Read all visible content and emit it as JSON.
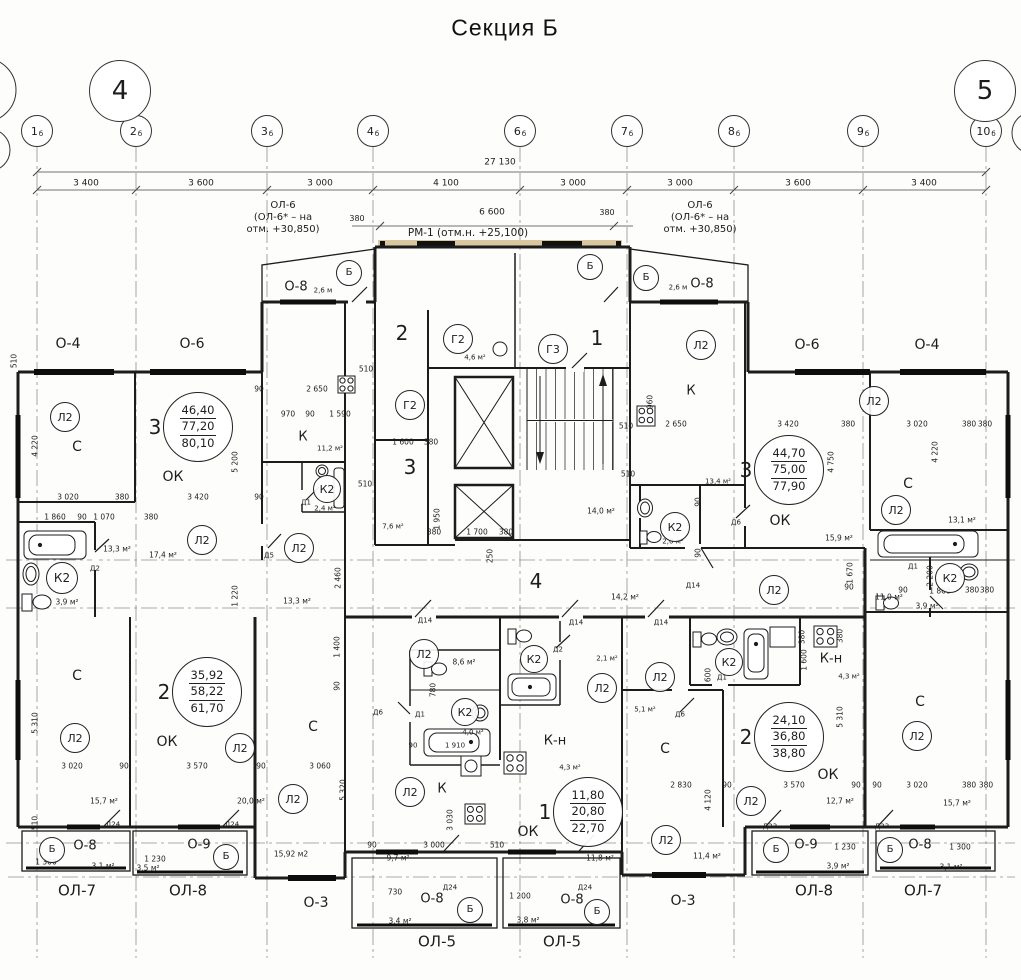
{
  "title": "Секция Б",
  "colors": {
    "wall": "#1c1c1c",
    "grid": "#8f8f8f",
    "dim": "#444444",
    "lintel_tan": "#d9c7a0"
  },
  "section_markers": [
    {
      "label": "4",
      "x": 120,
      "y": 91
    },
    {
      "label": "5",
      "x": 985,
      "y": 91
    }
  ],
  "axes": [
    {
      "label": "1",
      "sub": "б",
      "x": 37
    },
    {
      "label": "2",
      "sub": "б",
      "x": 136
    },
    {
      "label": "3",
      "sub": "б",
      "x": 267
    },
    {
      "label": "4",
      "sub": "б",
      "x": 373
    },
    {
      "label": "6",
      "sub": "б",
      "x": 520
    },
    {
      "label": "7",
      "sub": "б",
      "x": 627
    },
    {
      "label": "8",
      "sub": "б",
      "x": 734
    },
    {
      "label": "9",
      "sub": "б",
      "x": 863
    },
    {
      "label": "10",
      "sub": "б",
      "x": 986
    }
  ],
  "dims": {
    "total": "27 130",
    "total_x": 500,
    "total_y": 163,
    "segments": [
      {
        "label": "3 400",
        "x": 86
      },
      {
        "label": "3 600",
        "x": 201
      },
      {
        "label": "3 000",
        "x": 320
      },
      {
        "label": "4 100",
        "x": 446
      },
      {
        "label": "3 000",
        "x": 573
      },
      {
        "label": "3 000",
        "x": 680
      },
      {
        "label": "3 600",
        "x": 798
      },
      {
        "label": "3 400",
        "x": 924
      }
    ]
  },
  "stamps": [
    {
      "num": "3",
      "values": [
        "46,40",
        "77,20",
        "80,10"
      ],
      "x": 198,
      "y": 427
    },
    {
      "num": "3",
      "values": [
        "44,70",
        "75,00",
        "77,90"
      ],
      "x": 789,
      "y": 470
    },
    {
      "num": "2",
      "values": [
        "35,92",
        "58,22",
        "61,70"
      ],
      "x": 207,
      "y": 692
    },
    {
      "num": "2",
      "values": [
        "24,10",
        "36,80",
        "38,80"
      ],
      "x": 789,
      "y": 737
    },
    {
      "num": "1",
      "values": [
        "11,80",
        "20,80",
        "22,70"
      ],
      "x": 588,
      "y": 812
    }
  ],
  "circles": [
    {
      "t": "Л2",
      "x": 65,
      "y": 417,
      "r": 14
    },
    {
      "t": "Л2",
      "x": 202,
      "y": 540,
      "r": 14
    },
    {
      "t": "Л2",
      "x": 299,
      "y": 548,
      "r": 14
    },
    {
      "t": "Л2",
      "x": 701,
      "y": 345,
      "r": 14
    },
    {
      "t": "Л2",
      "x": 874,
      "y": 401,
      "r": 14
    },
    {
      "t": "Л2",
      "x": 896,
      "y": 510,
      "r": 14
    },
    {
      "t": "Л2",
      "x": 774,
      "y": 590,
      "r": 14
    },
    {
      "t": "Л2",
      "x": 424,
      "y": 654,
      "r": 14
    },
    {
      "t": "Л2",
      "x": 602,
      "y": 688,
      "r": 14
    },
    {
      "t": "Л2",
      "x": 660,
      "y": 677,
      "r": 14
    },
    {
      "t": "Л2",
      "x": 410,
      "y": 792,
      "r": 14
    },
    {
      "t": "Л2",
      "x": 75,
      "y": 738,
      "r": 14
    },
    {
      "t": "Л2",
      "x": 240,
      "y": 748,
      "r": 14
    },
    {
      "t": "Л2",
      "x": 293,
      "y": 799,
      "r": 14
    },
    {
      "t": "Л2",
      "x": 666,
      "y": 840,
      "r": 14
    },
    {
      "t": "Л2",
      "x": 751,
      "y": 801,
      "r": 14
    },
    {
      "t": "Л2",
      "x": 917,
      "y": 736,
      "r": 14
    },
    {
      "t": "К2",
      "x": 62,
      "y": 578,
      "r": 15
    },
    {
      "t": "К2",
      "x": 327,
      "y": 489,
      "r": 13
    },
    {
      "t": "К2",
      "x": 675,
      "y": 527,
      "r": 14
    },
    {
      "t": "К2",
      "x": 465,
      "y": 712,
      "r": 13
    },
    {
      "t": "К2",
      "x": 534,
      "y": 659,
      "r": 13
    },
    {
      "t": "К2",
      "x": 729,
      "y": 662,
      "r": 13
    },
    {
      "t": "К2",
      "x": 950,
      "y": 578,
      "r": 14
    },
    {
      "t": "Г2",
      "x": 458,
      "y": 339,
      "r": 14
    },
    {
      "t": "Г2",
      "x": 410,
      "y": 405,
      "r": 14
    },
    {
      "t": "Г3",
      "x": 553,
      "y": 349,
      "r": 14
    },
    {
      "t": "Б",
      "x": 349,
      "y": 273,
      "r": 12
    },
    {
      "t": "Б",
      "x": 590,
      "y": 267,
      "r": 12
    },
    {
      "t": "Б",
      "x": 646,
      "y": 278,
      "r": 12
    },
    {
      "t": "Б",
      "x": 52,
      "y": 850,
      "r": 12
    },
    {
      "t": "Б",
      "x": 226,
      "y": 857,
      "r": 12
    },
    {
      "t": "Б",
      "x": 470,
      "y": 910,
      "r": 12
    },
    {
      "t": "Б",
      "x": 597,
      "y": 912,
      "r": 12
    },
    {
      "t": "Б",
      "x": 776,
      "y": 850,
      "r": 12
    },
    {
      "t": "Б",
      "x": 890,
      "y": 850,
      "r": 12
    }
  ],
  "texts": [
    {
      "t": "380",
      "x": 357,
      "y": 219,
      "s": 8
    },
    {
      "t": "6 600",
      "x": 492,
      "y": 213,
      "s": 9
    },
    {
      "t": "380",
      "x": 607,
      "y": 213,
      "s": 8
    },
    {
      "t": "ОЛ-6",
      "x": 283,
      "y": 206,
      "s": 10
    },
    {
      "t": "(ОЛ-6* – на",
      "x": 283,
      "y": 218,
      "s": 10
    },
    {
      "t": "отм. +30,850)",
      "x": 283,
      "y": 230,
      "s": 10
    },
    {
      "t": "ОЛ-6",
      "x": 700,
      "y": 206,
      "s": 10
    },
    {
      "t": "(ОЛ-6* – на",
      "x": 700,
      "y": 218,
      "s": 10
    },
    {
      "t": "отм. +30,850)",
      "x": 700,
      "y": 230,
      "s": 10
    },
    {
      "t": "РМ-1 (отм.н. +25,100)",
      "x": 468,
      "y": 233,
      "s": 10.5
    },
    {
      "t": "О-4",
      "x": 68,
      "y": 344,
      "s": 14
    },
    {
      "t": "О-6",
      "x": 192,
      "y": 344,
      "s": 14
    },
    {
      "t": "О-6",
      "x": 807,
      "y": 345,
      "s": 14
    },
    {
      "t": "О-4",
      "x": 927,
      "y": 345,
      "s": 14
    },
    {
      "t": "О-8",
      "x": 296,
      "y": 287,
      "s": 13
    },
    {
      "t": "2,6 м",
      "x": 323,
      "y": 291,
      "s": 7
    },
    {
      "t": "О-8",
      "x": 702,
      "y": 284,
      "s": 13
    },
    {
      "t": "2,6 м",
      "x": 678,
      "y": 288,
      "s": 7
    },
    {
      "t": "О-8",
      "x": 85,
      "y": 846,
      "s": 13
    },
    {
      "t": "О-9",
      "x": 199,
      "y": 845,
      "s": 13
    },
    {
      "t": "О-9",
      "x": 806,
      "y": 845,
      "s": 13
    },
    {
      "t": "О-8",
      "x": 920,
      "y": 845,
      "s": 13
    },
    {
      "t": "О-8",
      "x": 432,
      "y": 899,
      "s": 13
    },
    {
      "t": "О-8",
      "x": 572,
      "y": 900,
      "s": 13
    },
    {
      "t": "О-3",
      "x": 316,
      "y": 903,
      "s": 14
    },
    {
      "t": "О-3",
      "x": 683,
      "y": 901,
      "s": 14
    },
    {
      "t": "ОЛ-7",
      "x": 77,
      "y": 891,
      "s": 15
    },
    {
      "t": "ОЛ-8",
      "x": 188,
      "y": 891,
      "s": 15
    },
    {
      "t": "ОЛ-5",
      "x": 437,
      "y": 942,
      "s": 15
    },
    {
      "t": "ОЛ-5",
      "x": 562,
      "y": 942,
      "s": 15
    },
    {
      "t": "ОЛ-8",
      "x": 814,
      "y": 891,
      "s": 15
    },
    {
      "t": "ОЛ-7",
      "x": 923,
      "y": 891,
      "s": 15
    },
    {
      "t": "С",
      "x": 77,
      "y": 447,
      "s": 14
    },
    {
      "t": "С",
      "x": 908,
      "y": 484,
      "s": 14
    },
    {
      "t": "С",
      "x": 77,
      "y": 676,
      "s": 14
    },
    {
      "t": "С",
      "x": 313,
      "y": 727,
      "s": 14
    },
    {
      "t": "С",
      "x": 665,
      "y": 749,
      "s": 14
    },
    {
      "t": "С",
      "x": 920,
      "y": 702,
      "s": 14
    },
    {
      "t": "К",
      "x": 303,
      "y": 437,
      "s": 13
    },
    {
      "t": "К",
      "x": 691,
      "y": 391,
      "s": 13
    },
    {
      "t": "К",
      "x": 442,
      "y": 789,
      "s": 13
    },
    {
      "t": "К-н",
      "x": 555,
      "y": 741,
      "s": 13
    },
    {
      "t": "К-н",
      "x": 831,
      "y": 659,
      "s": 13
    },
    {
      "t": "ОК",
      "x": 173,
      "y": 477,
      "s": 14
    },
    {
      "t": "ОК",
      "x": 780,
      "y": 521,
      "s": 14
    },
    {
      "t": "ОК",
      "x": 167,
      "y": 742,
      "s": 14
    },
    {
      "t": "ОК",
      "x": 828,
      "y": 775,
      "s": 14
    },
    {
      "t": "ОК",
      "x": 528,
      "y": 832,
      "s": 14
    },
    {
      "t": "2",
      "x": 402,
      "y": 333,
      "s": 20
    },
    {
      "t": "3",
      "x": 410,
      "y": 467,
      "s": 20
    },
    {
      "t": "1",
      "x": 597,
      "y": 338,
      "s": 20
    },
    {
      "t": "4",
      "x": 536,
      "y": 581,
      "s": 20
    },
    {
      "t": "17,4 м²",
      "x": 163,
      "y": 555
    },
    {
      "t": "13,3 м²",
      "x": 117,
      "y": 549
    },
    {
      "t": "13,3 м²",
      "x": 297,
      "y": 601
    },
    {
      "t": "3,9 м²",
      "x": 67,
      "y": 602
    },
    {
      "t": "11,2 м²",
      "x": 330,
      "y": 449,
      "s": 7
    },
    {
      "t": "2,4 м²",
      "x": 325,
      "y": 509,
      "s": 7
    },
    {
      "t": "7,6 м²",
      "x": 393,
      "y": 527,
      "s": 7
    },
    {
      "t": "4,6 м²",
      "x": 475,
      "y": 358,
      "s": 7
    },
    {
      "t": "14,0 м²",
      "x": 601,
      "y": 511
    },
    {
      "t": "14,2 м²",
      "x": 625,
      "y": 597
    },
    {
      "t": "2,0 м²",
      "x": 673,
      "y": 542,
      "s": 7
    },
    {
      "t": "13,4 м²",
      "x": 718,
      "y": 482,
      "s": 7
    },
    {
      "t": "15,9 м²",
      "x": 839,
      "y": 538
    },
    {
      "t": "13,1 м²",
      "x": 962,
      "y": 520
    },
    {
      "t": "3,9 м²",
      "x": 927,
      "y": 606
    },
    {
      "t": "11,0 м²",
      "x": 889,
      "y": 597
    },
    {
      "t": "8,6 м²",
      "x": 464,
      "y": 662
    },
    {
      "t": "2,1 м²",
      "x": 607,
      "y": 659,
      "s": 7
    },
    {
      "t": "4,0 м²",
      "x": 473,
      "y": 733,
      "s": 7
    },
    {
      "t": "4,3 м²",
      "x": 570,
      "y": 768,
      "s": 7
    },
    {
      "t": "4,3 м²",
      "x": 849,
      "y": 677,
      "s": 7
    },
    {
      "t": "5,1 м²",
      "x": 645,
      "y": 710,
      "s": 7
    },
    {
      "t": "9,7 м²",
      "x": 398,
      "y": 858
    },
    {
      "t": "11,8 м²",
      "x": 600,
      "y": 858
    },
    {
      "t": "15,92 м2",
      "x": 291,
      "y": 854
    },
    {
      "t": "15,7 м²",
      "x": 104,
      "y": 801
    },
    {
      "t": "20,0 м²",
      "x": 251,
      "y": 801
    },
    {
      "t": "11,4 м²",
      "x": 707,
      "y": 856
    },
    {
      "t": "12,7 м²",
      "x": 840,
      "y": 801
    },
    {
      "t": "15,7 м²",
      "x": 957,
      "y": 803
    },
    {
      "t": "3,1 м²",
      "x": 103,
      "y": 866
    },
    {
      "t": "3,5 м²",
      "x": 148,
      "y": 868
    },
    {
      "t": "3,4 м²",
      "x": 400,
      "y": 921
    },
    {
      "t": "3,8 м²",
      "x": 528,
      "y": 920
    },
    {
      "t": "3,9 м²",
      "x": 838,
      "y": 866
    },
    {
      "t": "3,1 м²",
      "x": 951,
      "y": 867
    },
    {
      "t": "Д2",
      "x": 95,
      "y": 569,
      "s": 7
    },
    {
      "t": "Д1",
      "x": 306,
      "y": 503,
      "s": 7
    },
    {
      "t": "Д5",
      "x": 269,
      "y": 556,
      "s": 7
    },
    {
      "t": "Д2",
      "x": 558,
      "y": 650,
      "s": 7
    },
    {
      "t": "Д1",
      "x": 420,
      "y": 715,
      "s": 7
    },
    {
      "t": "Д6",
      "x": 378,
      "y": 713,
      "s": 7
    },
    {
      "t": "Д1",
      "x": 722,
      "y": 678,
      "s": 7
    },
    {
      "t": "Д6",
      "x": 736,
      "y": 523,
      "s": 7
    },
    {
      "t": "Д6",
      "x": 680,
      "y": 715,
      "s": 7
    },
    {
      "t": "Д1",
      "x": 913,
      "y": 567,
      "s": 7
    },
    {
      "t": "Д14",
      "x": 425,
      "y": 621,
      "s": 7
    },
    {
      "t": "Д14",
      "x": 576,
      "y": 623,
      "s": 7
    },
    {
      "t": "Д14",
      "x": 661,
      "y": 623,
      "s": 7
    },
    {
      "t": "Д14",
      "x": 693,
      "y": 586,
      "s": 7
    },
    {
      "t": "Д24",
      "x": 113,
      "y": 825,
      "s": 7
    },
    {
      "t": "Д24",
      "x": 232,
      "y": 825,
      "s": 7
    },
    {
      "t": "Д24",
      "x": 450,
      "y": 888,
      "s": 7
    },
    {
      "t": "Д24",
      "x": 585,
      "y": 888,
      "s": 7
    },
    {
      "t": "Д23",
      "x": 770,
      "y": 827,
      "s": 7
    },
    {
      "t": "Д23",
      "x": 882,
      "y": 827,
      "s": 7
    },
    {
      "t": "3 020",
      "x": 68,
      "y": 497
    },
    {
      "t": "380",
      "x": 122,
      "y": 497
    },
    {
      "t": "3 420",
      "x": 198,
      "y": 497
    },
    {
      "t": "90",
      "x": 259,
      "y": 497
    },
    {
      "t": "1 860",
      "x": 55,
      "y": 517
    },
    {
      "t": "90",
      "x": 82,
      "y": 517
    },
    {
      "t": "1 070",
      "x": 104,
      "y": 517
    },
    {
      "t": "380",
      "x": 151,
      "y": 517
    },
    {
      "t": "90",
      "x": 259,
      "y": 389
    },
    {
      "t": "2 650",
      "x": 317,
      "y": 389
    },
    {
      "t": "970",
      "x": 288,
      "y": 414
    },
    {
      "t": "90",
      "x": 310,
      "y": 414
    },
    {
      "t": "1 590",
      "x": 340,
      "y": 414
    },
    {
      "t": "510",
      "x": 366,
      "y": 369
    },
    {
      "t": "510",
      "x": 365,
      "y": 484
    },
    {
      "t": "510",
      "x": 626,
      "y": 426
    },
    {
      "t": "510",
      "x": 628,
      "y": 474
    },
    {
      "t": "1 600",
      "x": 403,
      "y": 442
    },
    {
      "t": "380",
      "x": 431,
      "y": 442
    },
    {
      "t": "1 700",
      "x": 477,
      "y": 532
    },
    {
      "t": "380",
      "x": 434,
      "y": 532
    },
    {
      "t": "380",
      "x": 506,
      "y": 532
    },
    {
      "t": "2 650",
      "x": 676,
      "y": 424
    },
    {
      "t": "3 420",
      "x": 788,
      "y": 424
    },
    {
      "t": "380",
      "x": 848,
      "y": 424
    },
    {
      "t": "3 020",
      "x": 917,
      "y": 424
    },
    {
      "t": "380",
      "x": 969,
      "y": 424
    },
    {
      "t": "380",
      "x": 985,
      "y": 424
    },
    {
      "t": "90",
      "x": 849,
      "y": 587
    },
    {
      "t": "90",
      "x": 903,
      "y": 590
    },
    {
      "t": "1 860",
      "x": 940,
      "y": 591
    },
    {
      "t": "380",
      "x": 972,
      "y": 590
    },
    {
      "t": "380",
      "x": 987,
      "y": 590
    },
    {
      "t": "3 020",
      "x": 72,
      "y": 766
    },
    {
      "t": "90",
      "x": 124,
      "y": 766
    },
    {
      "t": "3 570",
      "x": 197,
      "y": 766
    },
    {
      "t": "90",
      "x": 261,
      "y": 766
    },
    {
      "t": "3 060",
      "x": 320,
      "y": 766
    },
    {
      "t": "2 830",
      "x": 681,
      "y": 785
    },
    {
      "t": "90",
      "x": 727,
      "y": 785
    },
    {
      "t": "3 570",
      "x": 794,
      "y": 785
    },
    {
      "t": "90",
      "x": 856,
      "y": 785
    },
    {
      "t": "90",
      "x": 877,
      "y": 785
    },
    {
      "t": "3 020",
      "x": 917,
      "y": 785
    },
    {
      "t": "380",
      "x": 969,
      "y": 785
    },
    {
      "t": "380",
      "x": 986,
      "y": 785
    },
    {
      "t": "1 910",
      "x": 455,
      "y": 746,
      "s": 7
    },
    {
      "t": "90",
      "x": 413,
      "y": 746,
      "s": 7
    },
    {
      "t": "3 000",
      "x": 434,
      "y": 845
    },
    {
      "t": "90",
      "x": 372,
      "y": 845
    },
    {
      "t": "510",
      "x": 497,
      "y": 845
    },
    {
      "t": "1 300",
      "x": 46,
      "y": 862
    },
    {
      "t": "1 230",
      "x": 155,
      "y": 859
    },
    {
      "t": "730",
      "x": 395,
      "y": 892
    },
    {
      "t": "1 200",
      "x": 520,
      "y": 896
    },
    {
      "t": "1 230",
      "x": 845,
      "y": 847
    },
    {
      "t": "1 300",
      "x": 960,
      "y": 847
    },
    {
      "t": "4 220",
      "x": 35,
      "y": 446,
      "r": 1
    },
    {
      "t": "5 200",
      "x": 235,
      "y": 462,
      "r": 1
    },
    {
      "t": "1 220",
      "x": 235,
      "y": 596,
      "r": 1
    },
    {
      "t": "2 460",
      "x": 338,
      "y": 578,
      "r": 1
    },
    {
      "t": "5 310",
      "x": 35,
      "y": 723,
      "r": 1
    },
    {
      "t": "5 320",
      "x": 343,
      "y": 790,
      "r": 1
    },
    {
      "t": "1 400",
      "x": 337,
      "y": 647,
      "r": 1
    },
    {
      "t": "90",
      "x": 337,
      "y": 686,
      "r": 1
    },
    {
      "t": "3 030",
      "x": 450,
      "y": 820,
      "r": 1
    },
    {
      "t": "780",
      "x": 433,
      "y": 690,
      "r": 1
    },
    {
      "t": "1 950",
      "x": 437,
      "y": 519,
      "r": 1
    },
    {
      "t": "250",
      "x": 490,
      "y": 556,
      "r": 1
    },
    {
      "t": "960",
      "x": 650,
      "y": 402,
      "r": 1
    },
    {
      "t": "4 750",
      "x": 831,
      "y": 462,
      "r": 1
    },
    {
      "t": "4 220",
      "x": 935,
      "y": 452,
      "r": 1
    },
    {
      "t": "1 670",
      "x": 850,
      "y": 573,
      "r": 1
    },
    {
      "t": "2 200",
      "x": 930,
      "y": 576,
      "r": 1
    },
    {
      "t": "5 310",
      "x": 840,
      "y": 717,
      "r": 1
    },
    {
      "t": "4 120",
      "x": 708,
      "y": 800,
      "r": 1
    },
    {
      "t": "1 600",
      "x": 804,
      "y": 660,
      "r": 1
    },
    {
      "t": "380",
      "x": 802,
      "y": 637,
      "r": 1
    },
    {
      "t": "380",
      "x": 840,
      "y": 636,
      "r": 1
    },
    {
      "t": "600",
      "x": 708,
      "y": 675,
      "r": 1
    },
    {
      "t": "510",
      "x": 35,
      "y": 823,
      "r": 1
    },
    {
      "t": "510",
      "x": 14,
      "y": 361,
      "r": 1
    },
    {
      "t": "90",
      "x": 698,
      "y": 502,
      "r": 1
    },
    {
      "t": "90",
      "x": 698,
      "y": 553,
      "r": 1
    }
  ]
}
